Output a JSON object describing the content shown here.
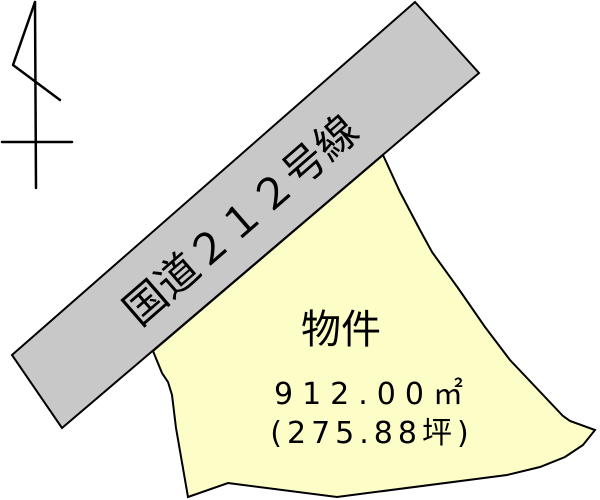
{
  "diagram": {
    "type": "real-estate site plan",
    "labels": {
      "road": "国道２１２号線",
      "parcel": "物件",
      "area_m2": "912.00㎡",
      "area_tsubo": "(275.88坪)"
    },
    "colors": {
      "road_fill": "#c8c8c8",
      "parcel_fill": "#fdfdc8",
      "line": "#000000",
      "background": "#ffffff"
    },
    "shapes": {
      "road_points": "12,355 415,2 479,73 62,428",
      "parcel_points": "153,351 383,155 400,192 420,230 432,252 458,288 485,327 510,360 563,416 570,421 595,430 583,445 565,457 540,467 507,475 337,497 228,483 188,497 176,428 172,395 168,382 162,373",
      "north_shaft": "35,2 36,188",
      "north_flag": "35,2 13,65 60,100",
      "north_crossbar": "2,142 72,142"
    }
  }
}
